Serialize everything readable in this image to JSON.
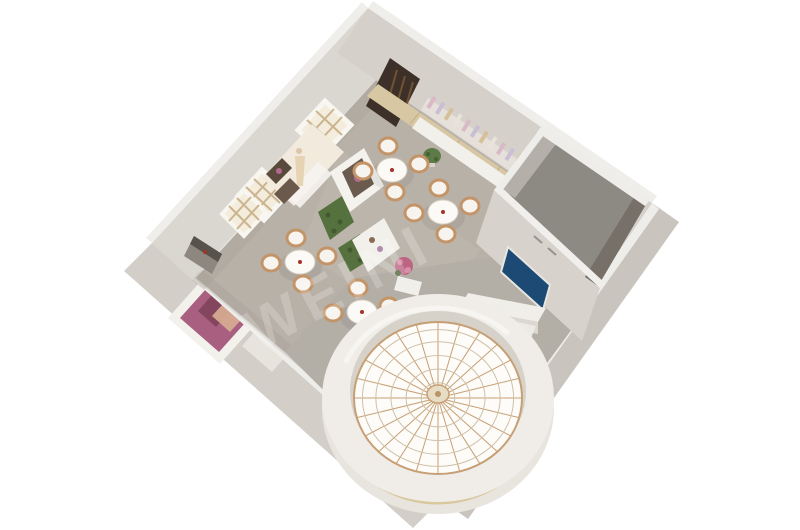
{
  "meta": {
    "description": "Aerial 3D rendering of a showroom interior with glass-dome rotunda",
    "view": "isometric top-down"
  },
  "watermark": {
    "text": "WEINI"
  },
  "counts": {
    "dining_tables": 4,
    "chairs_per_table": 4,
    "windows": 3
  },
  "colors": {
    "background": "#ffffff",
    "floor": "#b8b1a8",
    "floor_highlight": "#c2bbb1",
    "wall_interior_nw": "#dad6d0",
    "wall_interior_ne": "#d5d1ca",
    "wall_cap": "#eeede9",
    "wall_exterior_sw": "#d3cfc8",
    "wall_exterior_se": "#c9c5be",
    "roof": "#b3aea6",
    "room_floor": "#8d8983",
    "room_wall_light": "#b4b0a9",
    "room_wall_dark": "#767068",
    "tv_screen": "#1c4a74",
    "wood_strip": "#d8c7a3",
    "credenza": "#f2f0eb",
    "dome_ring": "#f0ede8",
    "dome_glass": "#fdfcf9",
    "dome_rib": "#c79f74",
    "dome_band": "#d9c79e",
    "hedge_green": "#55713e",
    "flower_pink": "#bc6583",
    "poster_magenta": "#a85f80",
    "doorway_dark": "#3c3028",
    "chair_wicker": "#c39468",
    "chair_cushion": "#f7f4ef",
    "table_top": "#fbfaf6",
    "centerpiece_red": "#a33327",
    "alcove_cream": "#f1eadd",
    "window_pane": "#f4ecdc",
    "window_grid": "#cbb58f",
    "product_colors": [
      "#d9b9c6",
      "#c9bed3",
      "#d6c09a",
      "#e8e2d8"
    ]
  }
}
